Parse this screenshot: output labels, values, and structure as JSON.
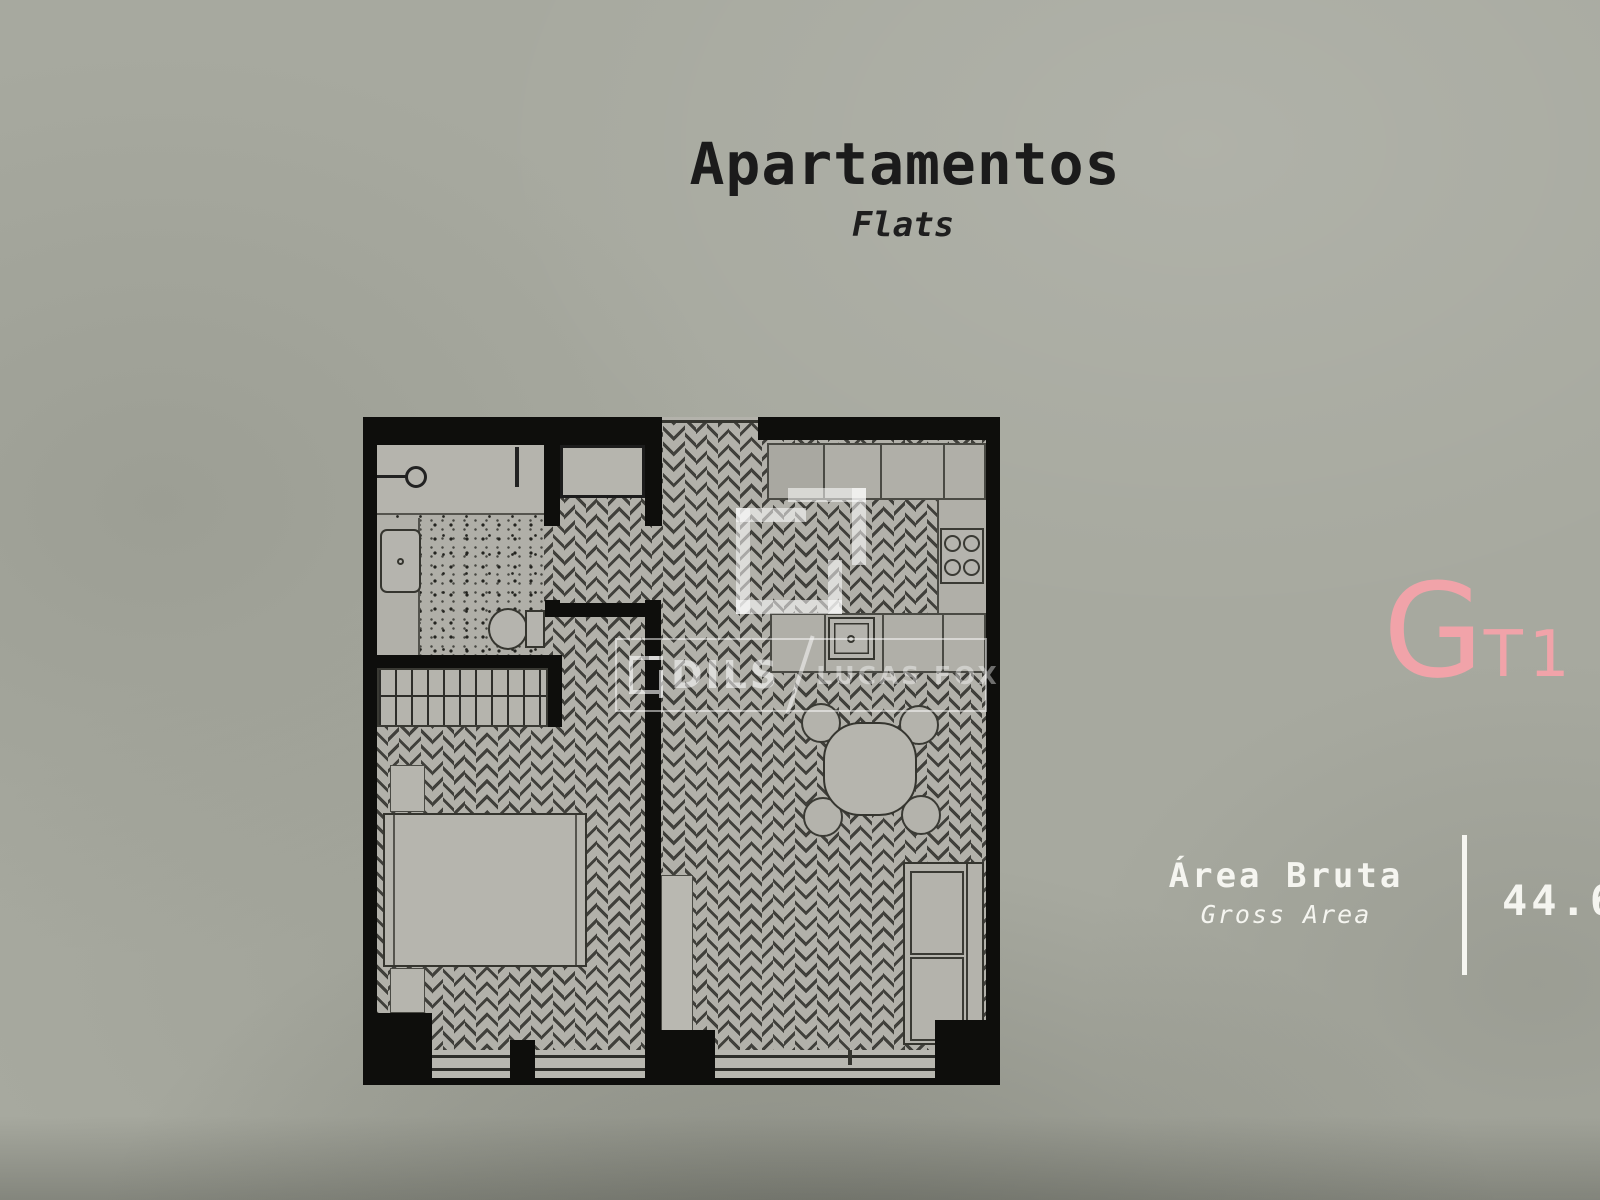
{
  "header": {
    "title": "Apartamentos",
    "subtitle": "Flats"
  },
  "unit": {
    "letter": "G",
    "code": "T1"
  },
  "area": {
    "label": "Área Bruta",
    "label_translation": "Gross Area",
    "value": "44.6"
  },
  "watermark": {
    "brand_primary": "DILS",
    "divider": "/",
    "brand_secondary": "LUCAS FOX"
  },
  "colors": {
    "background": "#a7a99f",
    "accent_pink": "#f1a3a9",
    "wall_black": "#0e0e0c",
    "floor_gray": "#b3b2ab",
    "text_dark": "#1b1b1b",
    "text_light": "#f5f5f0"
  }
}
